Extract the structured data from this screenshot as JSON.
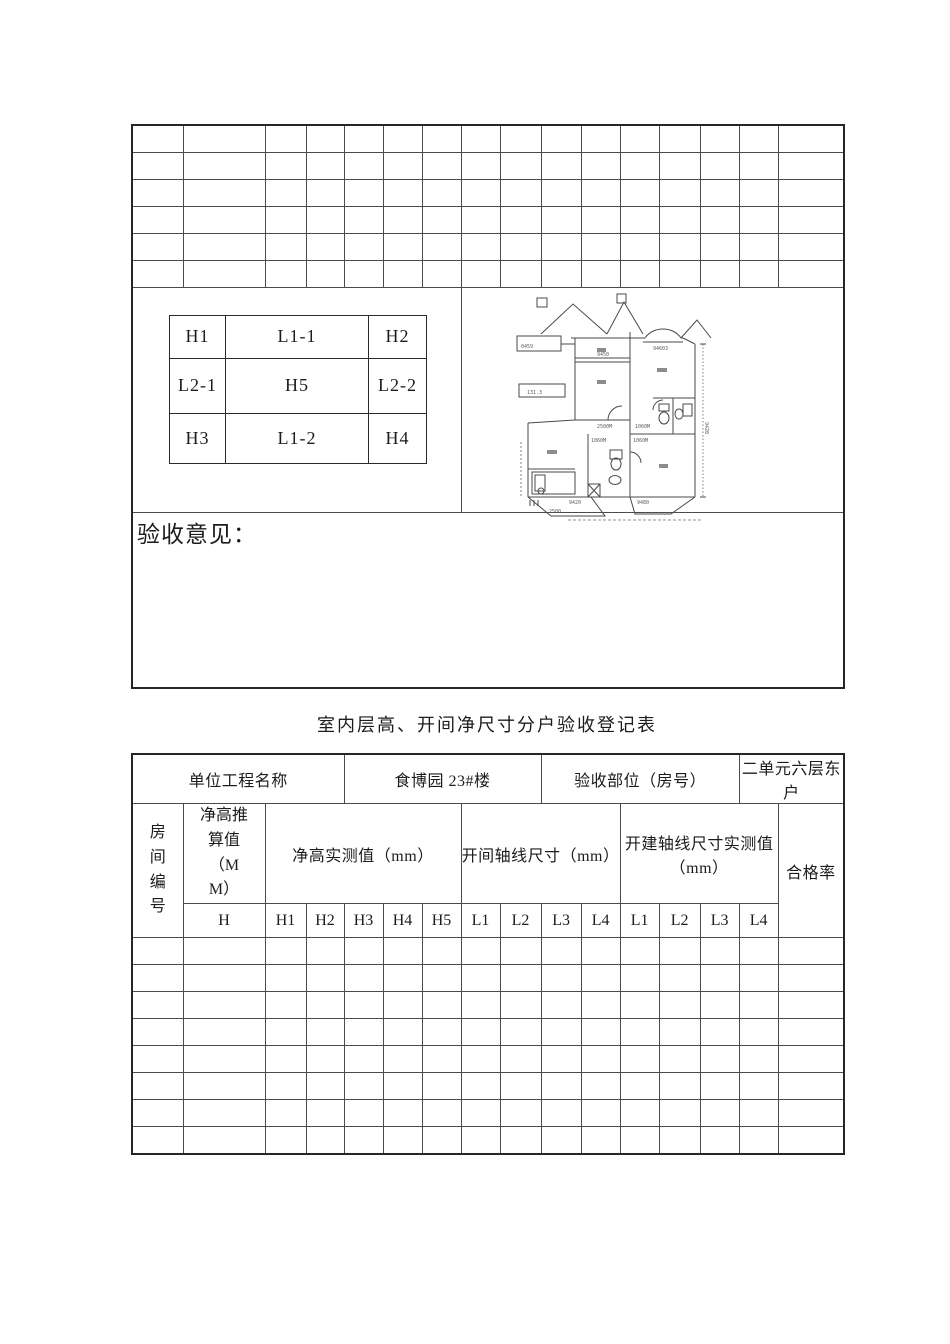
{
  "upper": {
    "h_table": {
      "cells": [
        "H1",
        "L1-1",
        "H2",
        "L2-1",
        "H5",
        "L2-2",
        "H3",
        "L1-2",
        "H4"
      ]
    },
    "opinion_label": "验收意见：",
    "floor_plan": {
      "labels": [
        "0459",
        "9450",
        "94603",
        "131.3",
        "2500M",
        "1060M",
        "1060M",
        "1060M",
        "9420",
        "9420",
        "9480",
        "2500"
      ]
    }
  },
  "title": "室内层高、开间净尺寸分户验收登记表",
  "lower": {
    "info": {
      "unit_label": "单位工程名称",
      "unit_value": "食博园 23#楼",
      "part_label": "验收部位（房号）",
      "part_value": "二单元六层东户"
    },
    "header": {
      "room_no": "房间编号",
      "height_calc": "净高推算值（MM）",
      "height_measured": "净高实测值（mm）",
      "bay_axis": "开间轴线尺寸（mm）",
      "bay_measured": "开建轴线尺寸实测值（mm）",
      "pass_rate": "合格率",
      "sub": [
        "H",
        "H1",
        "H2",
        "H3",
        "H4",
        "H5",
        "L1",
        "L2",
        "L3",
        "L4",
        "L1",
        "L2",
        "L3",
        "L4"
      ]
    }
  }
}
